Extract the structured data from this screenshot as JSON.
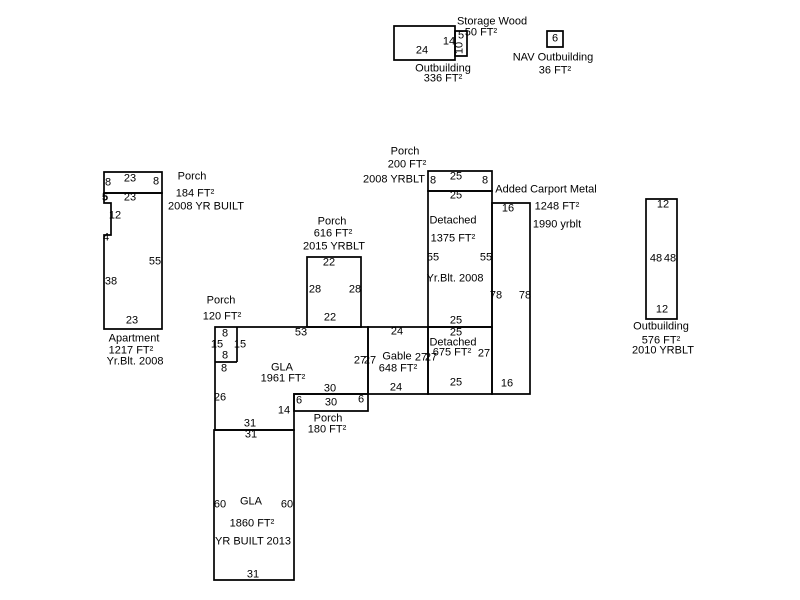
{
  "canvas": {
    "width": 800,
    "height": 600,
    "background": "#ffffff",
    "line_color": "#000000",
    "text_color": "#000000"
  },
  "buildings": [
    {
      "id": "outbuilding-336",
      "shapes": [
        {
          "rect": [
            394,
            26,
            61,
            34
          ]
        }
      ],
      "dims": [
        {
          "t": "24",
          "x": 422,
          "y": 51
        },
        {
          "t": "14",
          "x": 449,
          "y": 42
        }
      ],
      "captions": [
        {
          "t": "Outbuilding",
          "x": 443,
          "y": 69
        },
        {
          "t": "336 FT²",
          "x": 443,
          "y": 79
        }
      ]
    },
    {
      "id": "storage-wood",
      "shapes": [
        {
          "rect": [
            455,
            31,
            12,
            25
          ]
        }
      ],
      "dims": [
        {
          "t": "5",
          "x": 461,
          "y": 36
        },
        {
          "t": "10",
          "x": 460,
          "y": 48,
          "rot": true
        }
      ],
      "captions": [
        {
          "t": "Storage Wood",
          "x": 492,
          "y": 22
        },
        {
          "t": "50 FT²",
          "x": 481,
          "y": 33
        }
      ]
    },
    {
      "id": "nav-outbuilding",
      "shapes": [
        {
          "rect": [
            547,
            31,
            16,
            16
          ]
        }
      ],
      "dims": [
        {
          "t": "6",
          "x": 555,
          "y": 39
        }
      ],
      "captions": [
        {
          "t": "NAV Outbuilding",
          "x": 553,
          "y": 58
        },
        {
          "t": "36 FT²",
          "x": 555,
          "y": 71
        }
      ]
    },
    {
      "id": "apartment-porch",
      "shapes": [
        {
          "rect": [
            104,
            172,
            58,
            21
          ]
        }
      ],
      "dims": [
        {
          "t": "23",
          "x": 130,
          "y": 179
        },
        {
          "t": "8",
          "x": 108,
          "y": 183
        },
        {
          "t": "8",
          "x": 156,
          "y": 182
        }
      ],
      "captions": [
        {
          "t": "Porch",
          "x": 192,
          "y": 177
        },
        {
          "t": "184 FT²",
          "x": 195,
          "y": 194
        },
        {
          "t": "2008 YR BUILT",
          "x": 206,
          "y": 207
        }
      ]
    },
    {
      "id": "apartment",
      "shapes": [
        {
          "poly": [
            [
              104,
              193
            ],
            [
              162,
              193
            ],
            [
              162,
              329
            ],
            [
              104,
              329
            ],
            [
              104,
              235
            ],
            [
              111,
              235
            ],
            [
              111,
              203
            ],
            [
              104,
              203
            ]
          ]
        }
      ],
      "dims": [
        {
          "t": "23",
          "x": 130,
          "y": 198
        },
        {
          "t": "5",
          "x": 105,
          "y": 198,
          "bold": true
        },
        {
          "t": "12",
          "x": 115,
          "y": 216
        },
        {
          "t": "4",
          "x": 106,
          "y": 238
        },
        {
          "t": "55",
          "x": 155,
          "y": 262
        },
        {
          "t": "38",
          "x": 111,
          "y": 282
        },
        {
          "t": "23",
          "x": 132,
          "y": 321
        }
      ],
      "captions": [
        {
          "t": "Apartment",
          "x": 134,
          "y": 339
        },
        {
          "t": "1217 FT²",
          "x": 131,
          "y": 351
        },
        {
          "t": "Yr.Blt. 2008",
          "x": 135,
          "y": 362
        }
      ]
    },
    {
      "id": "porch-616",
      "shapes": [
        {
          "rect": [
            307,
            257,
            54,
            70
          ]
        }
      ],
      "dims": [
        {
          "t": "22",
          "x": 329,
          "y": 263
        },
        {
          "t": "28",
          "x": 315,
          "y": 290
        },
        {
          "t": "28",
          "x": 355,
          "y": 290
        },
        {
          "t": "22",
          "x": 330,
          "y": 318
        }
      ],
      "captions": [
        {
          "t": "Porch",
          "x": 332,
          "y": 222
        },
        {
          "t": "616 FT²",
          "x": 333,
          "y": 234
        },
        {
          "t": "2015 YRBLT",
          "x": 334,
          "y": 247
        }
      ]
    },
    {
      "id": "porch-120",
      "shapes": [
        {
          "line": [
            237,
            327,
            237,
            362
          ]
        },
        {
          "line": [
            215,
            362,
            237,
            362
          ]
        }
      ],
      "dims": [
        {
          "t": "8",
          "x": 225,
          "y": 334
        },
        {
          "t": "15",
          "x": 217,
          "y": 345
        },
        {
          "t": "15",
          "x": 240,
          "y": 345
        },
        {
          "t": "8",
          "x": 225,
          "y": 356
        },
        {
          "t": "8",
          "x": 224,
          "y": 369
        }
      ],
      "captions": [
        {
          "t": "Porch",
          "x": 221,
          "y": 301
        },
        {
          "t": "120 FT²",
          "x": 222,
          "y": 317
        }
      ]
    },
    {
      "id": "gla-upper",
      "shapes": [
        {
          "poly": [
            [
              215,
              327
            ],
            [
              368,
              327
            ],
            [
              368,
              394
            ],
            [
              294,
              394
            ],
            [
              294,
              430
            ],
            [
              215,
              430
            ]
          ]
        }
      ],
      "dims": [
        {
          "t": "53",
          "x": 301,
          "y": 333
        },
        {
          "t": "26",
          "x": 220,
          "y": 398
        },
        {
          "t": "27",
          "x": 360,
          "y": 361
        },
        {
          "t": "30",
          "x": 330,
          "y": 389
        },
        {
          "t": "31",
          "x": 250,
          "y": 424
        },
        {
          "t": "14",
          "x": 284,
          "y": 411
        }
      ],
      "captions": [
        {
          "t": "GLA",
          "x": 282,
          "y": 368
        },
        {
          "t": "1961 FT²",
          "x": 283,
          "y": 379
        }
      ]
    },
    {
      "id": "porch-180",
      "shapes": [
        {
          "rect": [
            294,
            394,
            74,
            17
          ]
        }
      ],
      "dims": [
        {
          "t": "6",
          "x": 299,
          "y": 401
        },
        {
          "t": "30",
          "x": 331,
          "y": 403
        },
        {
          "t": "6",
          "x": 361,
          "y": 400
        }
      ],
      "captions": [
        {
          "t": "Porch",
          "x": 328,
          "y": 419
        },
        {
          "t": "180 FT²",
          "x": 327,
          "y": 430
        }
      ]
    },
    {
      "id": "gla-lower",
      "shapes": [
        {
          "rect": [
            214,
            430,
            80,
            150
          ]
        }
      ],
      "dims": [
        {
          "t": "31",
          "x": 251,
          "y": 435
        },
        {
          "t": "60",
          "x": 220,
          "y": 505
        },
        {
          "t": "60",
          "x": 287,
          "y": 505
        },
        {
          "t": "31",
          "x": 253,
          "y": 575
        }
      ],
      "captions": [
        {
          "t": "GLA",
          "x": 251,
          "y": 502
        },
        {
          "t": "1860 FT²",
          "x": 252,
          "y": 524
        },
        {
          "t": "YR BUILT 2013",
          "x": 253,
          "y": 542
        }
      ]
    },
    {
      "id": "gable",
      "shapes": [
        {
          "rect": [
            368,
            327,
            60,
            67
          ]
        }
      ],
      "dims": [
        {
          "t": "24",
          "x": 397,
          "y": 332
        },
        {
          "t": "27",
          "x": 370,
          "y": 361
        },
        {
          "t": "27",
          "x": 421,
          "y": 358
        },
        {
          "t": "24",
          "x": 396,
          "y": 388
        }
      ],
      "captions": [
        {
          "t": "Gable",
          "x": 397,
          "y": 357
        },
        {
          "t": "648 FT²",
          "x": 398,
          "y": 369
        }
      ]
    },
    {
      "id": "detached-675",
      "shapes": [
        {
          "rect": [
            428,
            327,
            64,
            67
          ]
        }
      ],
      "dims": [
        {
          "t": "25",
          "x": 456,
          "y": 333
        },
        {
          "t": "27",
          "x": 431,
          "y": 358
        },
        {
          "t": "27",
          "x": 484,
          "y": 354
        },
        {
          "t": "25",
          "x": 456,
          "y": 383
        }
      ],
      "captions": [
        {
          "t": "Detached",
          "x": 453,
          "y": 343
        },
        {
          "t": "675 FT²",
          "x": 452,
          "y": 353
        }
      ]
    },
    {
      "id": "detached-1375",
      "shapes": [
        {
          "rect": [
            428,
            191,
            64,
            136
          ]
        }
      ],
      "dims": [
        {
          "t": "25",
          "x": 456,
          "y": 196
        },
        {
          "t": "55",
          "x": 433,
          "y": 258
        },
        {
          "t": "55",
          "x": 486,
          "y": 258
        },
        {
          "t": "25",
          "x": 456,
          "y": 321
        }
      ],
      "captions": [
        {
          "t": "Detached",
          "x": 453,
          "y": 221
        },
        {
          "t": "1375 FT²",
          "x": 453,
          "y": 239
        },
        {
          "t": "Yr.Blt. 2008",
          "x": 455,
          "y": 279
        }
      ]
    },
    {
      "id": "porch-200",
      "shapes": [
        {
          "rect": [
            428,
            171,
            64,
            20
          ]
        }
      ],
      "dims": [
        {
          "t": "8",
          "x": 433,
          "y": 181
        },
        {
          "t": "25",
          "x": 456,
          "y": 177
        },
        {
          "t": "8",
          "x": 485,
          "y": 181
        }
      ],
      "captions": [
        {
          "t": "Porch",
          "x": 405,
          "y": 152
        },
        {
          "t": "200 FT²",
          "x": 407,
          "y": 165
        },
        {
          "t": "2008 YRBLT",
          "x": 394,
          "y": 180
        }
      ]
    },
    {
      "id": "added-carport",
      "shapes": [
        {
          "rect": [
            492,
            203,
            38,
            191
          ]
        }
      ],
      "dims": [
        {
          "t": "16",
          "x": 508,
          "y": 209
        },
        {
          "t": "78",
          "x": 496,
          "y": 296
        },
        {
          "t": "78",
          "x": 525,
          "y": 296
        },
        {
          "t": "16",
          "x": 507,
          "y": 384
        }
      ],
      "captions": [
        {
          "t": "Added Carport Metal",
          "x": 546,
          "y": 190
        },
        {
          "t": "1248 FT²",
          "x": 557,
          "y": 207
        },
        {
          "t": "1990 yrblt",
          "x": 557,
          "y": 225
        }
      ]
    },
    {
      "id": "outbuilding-576",
      "shapes": [
        {
          "rect": [
            646,
            199,
            31,
            120
          ]
        }
      ],
      "dims": [
        {
          "t": "12",
          "x": 663,
          "y": 205
        },
        {
          "t": "48",
          "x": 656,
          "y": 259
        },
        {
          "t": "48",
          "x": 670,
          "y": 259
        },
        {
          "t": "12",
          "x": 662,
          "y": 310
        }
      ],
      "captions": [
        {
          "t": "Outbuilding",
          "x": 661,
          "y": 327
        },
        {
          "t": "576 FT²",
          "x": 661,
          "y": 341
        },
        {
          "t": "2010 YRBLT",
          "x": 663,
          "y": 351
        }
      ]
    }
  ]
}
